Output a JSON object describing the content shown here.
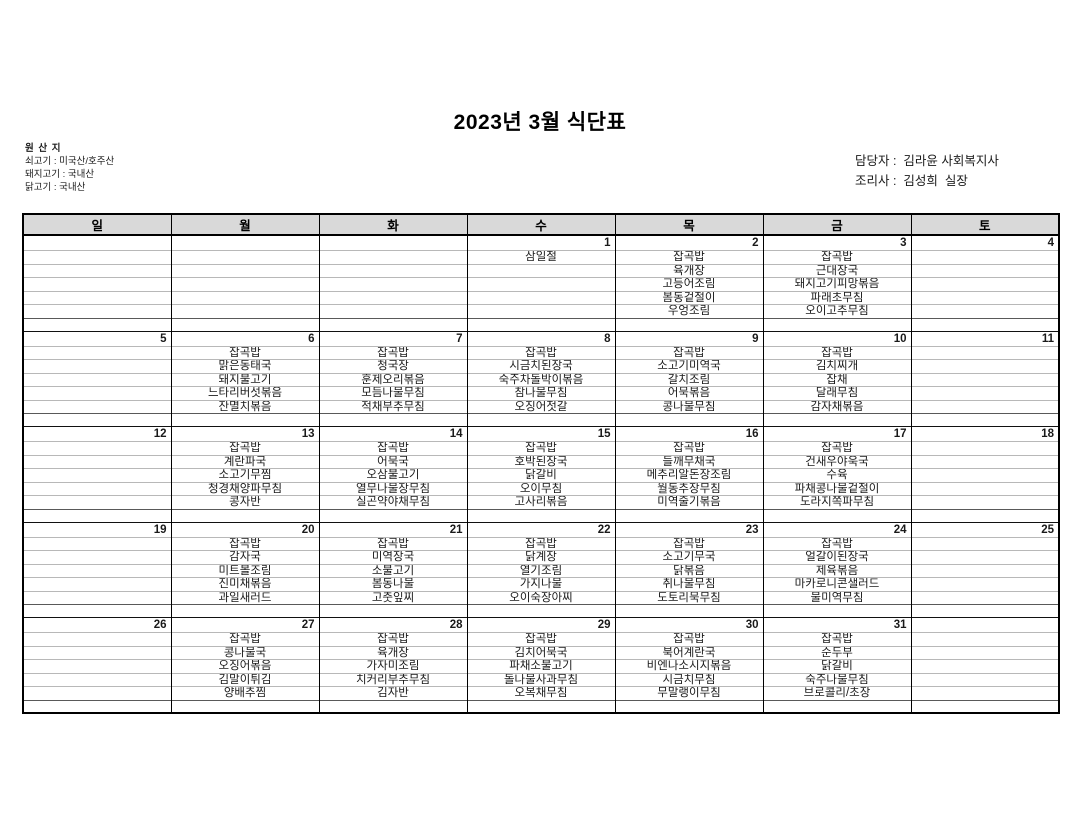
{
  "title": "2023년 3월 식단표",
  "origin": {
    "heading": "원 산 지",
    "lines": [
      "쇠고기 : 미국산/호주산",
      "돼지고기 : 국내산",
      "닭고기 : 국내산"
    ]
  },
  "staff": {
    "manager_line": "담당자 :  김라윤 사회복지사",
    "cook_line": "조리사 :  김성희  실장"
  },
  "colors": {
    "sunday_holiday_red": "#FF0000",
    "saturday_blue": "#0070C0",
    "header_bg": "#D9D9D9"
  },
  "calendar": {
    "day_headers": [
      "일",
      "월",
      "화",
      "수",
      "목",
      "금",
      "토"
    ],
    "menu_rows_per_week": 5,
    "weeks": [
      {
        "days": [
          {
            "date": "",
            "menu": []
          },
          {
            "date": "",
            "menu": []
          },
          {
            "date": "",
            "menu": []
          },
          {
            "date": "1",
            "date_color": "red",
            "menu_color": "red",
            "menu": [
              "삼일절"
            ]
          },
          {
            "date": "2",
            "menu": [
              "잡곡밥",
              "육개장",
              "고등어조림",
              "봄동겉절이",
              "우엉조림"
            ]
          },
          {
            "date": "3",
            "menu": [
              "잡곡밥",
              "근대장국",
              "돼지고기피망볶음",
              "파래초무침",
              "오이고추무침"
            ]
          },
          {
            "date": "4",
            "date_color": "blue",
            "menu": []
          }
        ]
      },
      {
        "days": [
          {
            "date": "5",
            "date_color": "red",
            "menu": []
          },
          {
            "date": "6",
            "menu": [
              "잡곡밥",
              "맑은동태국",
              "돼지불고기",
              "느타리버섯볶음",
              "잔멸치볶음"
            ]
          },
          {
            "date": "7",
            "menu": [
              "잡곡밥",
              "청국장",
              "훈제오리볶음",
              "모듬나물무침",
              "적채부추무침"
            ]
          },
          {
            "date": "8",
            "menu": [
              "잡곡밥",
              "시금치된장국",
              "숙주차돌박이볶음",
              "참나물무침",
              "오징어젓갈"
            ]
          },
          {
            "date": "9",
            "menu": [
              "잡곡밥",
              "소고기미역국",
              "갈치조림",
              "어묵볶음",
              "콩나물무침"
            ]
          },
          {
            "date": "10",
            "menu": [
              "잡곡밥",
              "김치찌개",
              "잡채",
              "달래무침",
              "감자채볶음"
            ]
          },
          {
            "date": "11",
            "date_color": "blue",
            "menu": []
          }
        ]
      },
      {
        "days": [
          {
            "date": "12",
            "date_color": "red",
            "menu": []
          },
          {
            "date": "13",
            "menu": [
              "잡곡밥",
              "계란파국",
              "소고기무찜",
              "청경채양파무침",
              "콩자반"
            ]
          },
          {
            "date": "14",
            "menu": [
              "잡곡밥",
              "어묵국",
              "오삼불고기",
              "열무나물장무침",
              "실곤약야채무침"
            ]
          },
          {
            "date": "15",
            "menu": [
              "잡곡밥",
              "호박된장국",
              "닭갈비",
              "오이무침",
              "고사리볶음"
            ]
          },
          {
            "date": "16",
            "menu": [
              "잡곡밥",
              "들깨무채국",
              "메추리알돈장조림",
              "월동추장무침",
              "미역줄기볶음"
            ]
          },
          {
            "date": "17",
            "menu": [
              "잡곡밥",
              "건새우야욱국",
              "수육",
              "파채콩나물겉절이",
              "도라지쪽파무침"
            ]
          },
          {
            "date": "18",
            "date_color": "blue",
            "menu": []
          }
        ]
      },
      {
        "days": [
          {
            "date": "19",
            "date_color": "red",
            "menu": []
          },
          {
            "date": "20",
            "menu": [
              "잡곡밥",
              "감자국",
              "미트볼조림",
              "진미채볶음",
              "과일새러드"
            ]
          },
          {
            "date": "21",
            "menu": [
              "잡곡밥",
              "미역장국",
              "소불고기",
              "봄동나물",
              "고춧잎찌"
            ]
          },
          {
            "date": "22",
            "menu": [
              "잡곡밥",
              "닭계장",
              "열기조림",
              "가지나물",
              "오이숙장아찌"
            ]
          },
          {
            "date": "23",
            "menu": [
              "잡곡밥",
              "소고기무국",
              "닭볶음",
              "취나물무침",
              "도토리묵무침"
            ]
          },
          {
            "date": "24",
            "menu": [
              "잡곡밥",
              "얼갈이된장국",
              "제육볶음",
              "마카로니콘샐러드",
              "물미역무침"
            ]
          },
          {
            "date": "25",
            "date_color": "blue",
            "menu": []
          }
        ]
      },
      {
        "days": [
          {
            "date": "26",
            "date_color": "red",
            "menu": []
          },
          {
            "date": "27",
            "menu": [
              "잡곡밥",
              "콩나물국",
              "오징어볶음",
              "김말이튀김",
              "양배추찜"
            ]
          },
          {
            "date": "28",
            "menu": [
              "잡곡밥",
              "육개장",
              "가자미조림",
              "치커리부추무침",
              "김자반"
            ]
          },
          {
            "date": "29",
            "menu": [
              "잡곡밥",
              "김치어묵국",
              "파채소불고기",
              "돌나물사과무침",
              "오복채무침"
            ]
          },
          {
            "date": "30",
            "menu": [
              "잡곡밥",
              "북어계란국",
              "비엔나소시지볶음",
              "시금치무침",
              "무말랭이무침"
            ]
          },
          {
            "date": "31",
            "menu": [
              "잡곡밥",
              "순두부",
              "닭갈비",
              "숙주나물무침",
              "브로콜리/초장"
            ]
          },
          {
            "date": "",
            "menu": []
          }
        ]
      }
    ]
  }
}
